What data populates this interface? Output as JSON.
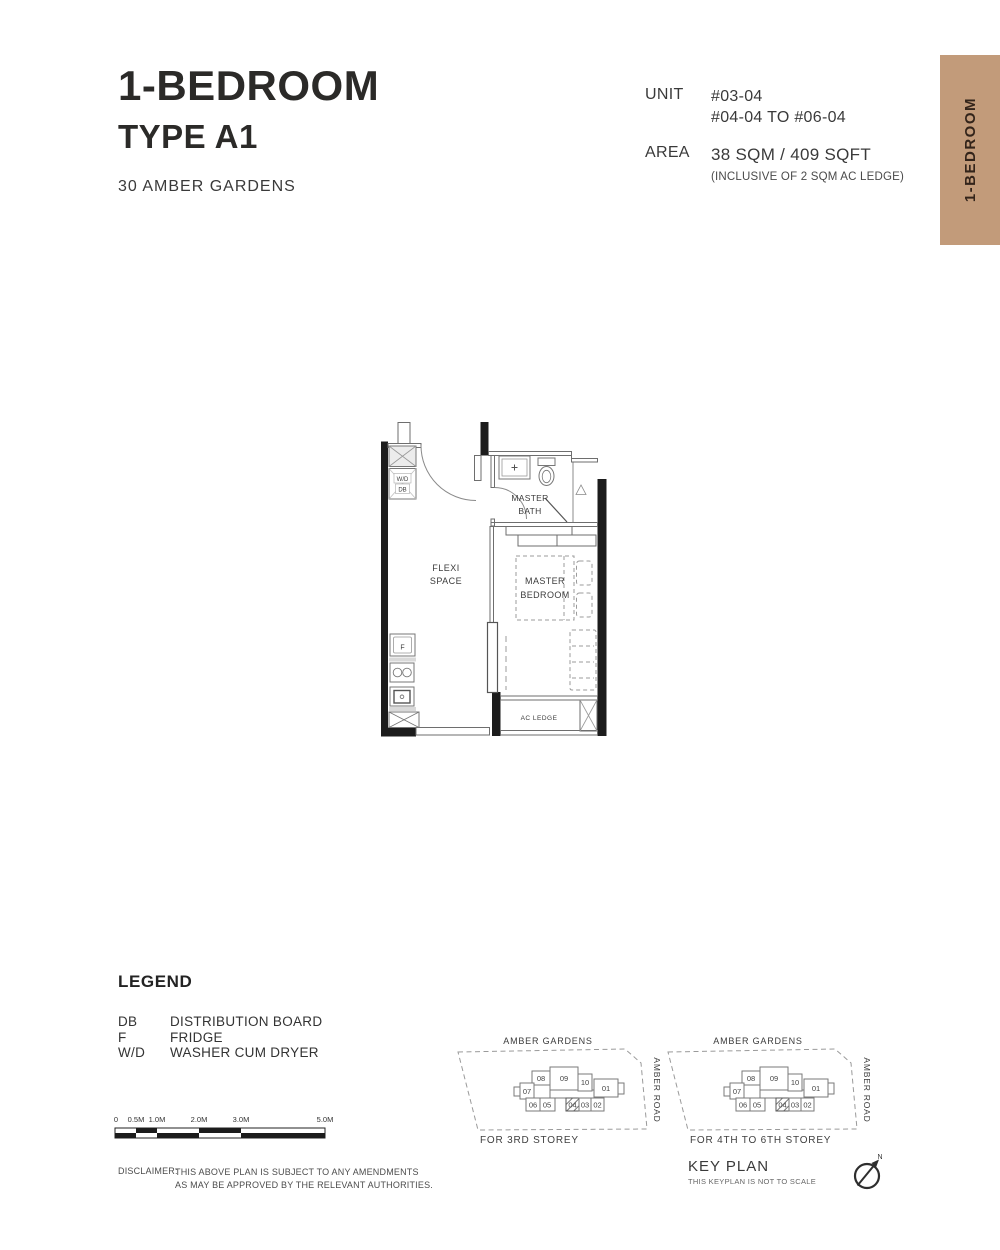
{
  "colors": {
    "tab_bg": "#c29b7a",
    "ink": "#2b2a28",
    "wall": "#1c1c1c"
  },
  "header": {
    "title": "1-BEDROOM",
    "subtitle": "TYPE A1",
    "project": "30 AMBER GARDENS",
    "unit_label": "UNIT",
    "unit_lines": [
      "#03-04",
      "#04-04 TO #06-04"
    ],
    "area_label": "AREA",
    "area_value": "38 SQM / 409 SQFT",
    "area_note": "(INCLUSIVE OF 2 SQM AC LEDGE)"
  },
  "side_tab": {
    "label": "1-BEDROOM"
  },
  "floorplan": {
    "labels": {
      "wd": "W/D",
      "db": "DB",
      "bath1": "MASTER",
      "bath2": "BATH",
      "flexi1": "FLEXI",
      "flexi2": "SPACE",
      "bed1": "MASTER",
      "bed2": "BEDROOM",
      "fridge": "F",
      "ac_ledge": "AC LEDGE"
    }
  },
  "legend": {
    "title": "LEGEND",
    "items": [
      {
        "abbr": "DB",
        "desc": "DISTRIBUTION BOARD"
      },
      {
        "abbr": "F",
        "desc": "FRIDGE"
      },
      {
        "abbr": "W/D",
        "desc": "WASHER CUM DRYER"
      }
    ]
  },
  "scalebar": {
    "ticks": [
      "0",
      "0.5M",
      "1.0M",
      "2.0M",
      "3.0M",
      "5.0M"
    ]
  },
  "disclaimer": {
    "label": "DISCLAIMER:",
    "lines": [
      "THIS ABOVE PLAN IS SUBJECT TO ANY AMENDMENTS",
      "AS MAY BE APPROVED BY THE RELEVANT AUTHORITIES."
    ]
  },
  "keyplans": [
    {
      "road_top": "AMBER GARDENS",
      "road_right": "AMBER ROAD",
      "caption": "FOR 3RD STOREY",
      "highlighted_unit": "04",
      "units": {
        "u08": "08",
        "u09": "09",
        "u10": "10",
        "u01": "01",
        "u07": "07",
        "u06": "06",
        "u05": "05",
        "u04": "04",
        "u03": "03",
        "u02": "02"
      }
    },
    {
      "road_top": "AMBER GARDENS",
      "road_right": "AMBER ROAD",
      "caption": "FOR 4TH TO 6TH STOREY",
      "highlighted_unit": "04",
      "units": {
        "u08": "08",
        "u09": "09",
        "u10": "10",
        "u01": "01",
        "u07": "07",
        "u06": "06",
        "u05": "05",
        "u04": "04",
        "u03": "03",
        "u02": "02"
      }
    }
  ],
  "keyplan_footer": {
    "title": "KEY PLAN",
    "note": "THIS KEYPLAN IS NOT TO SCALE"
  },
  "north": {
    "label": "N"
  }
}
